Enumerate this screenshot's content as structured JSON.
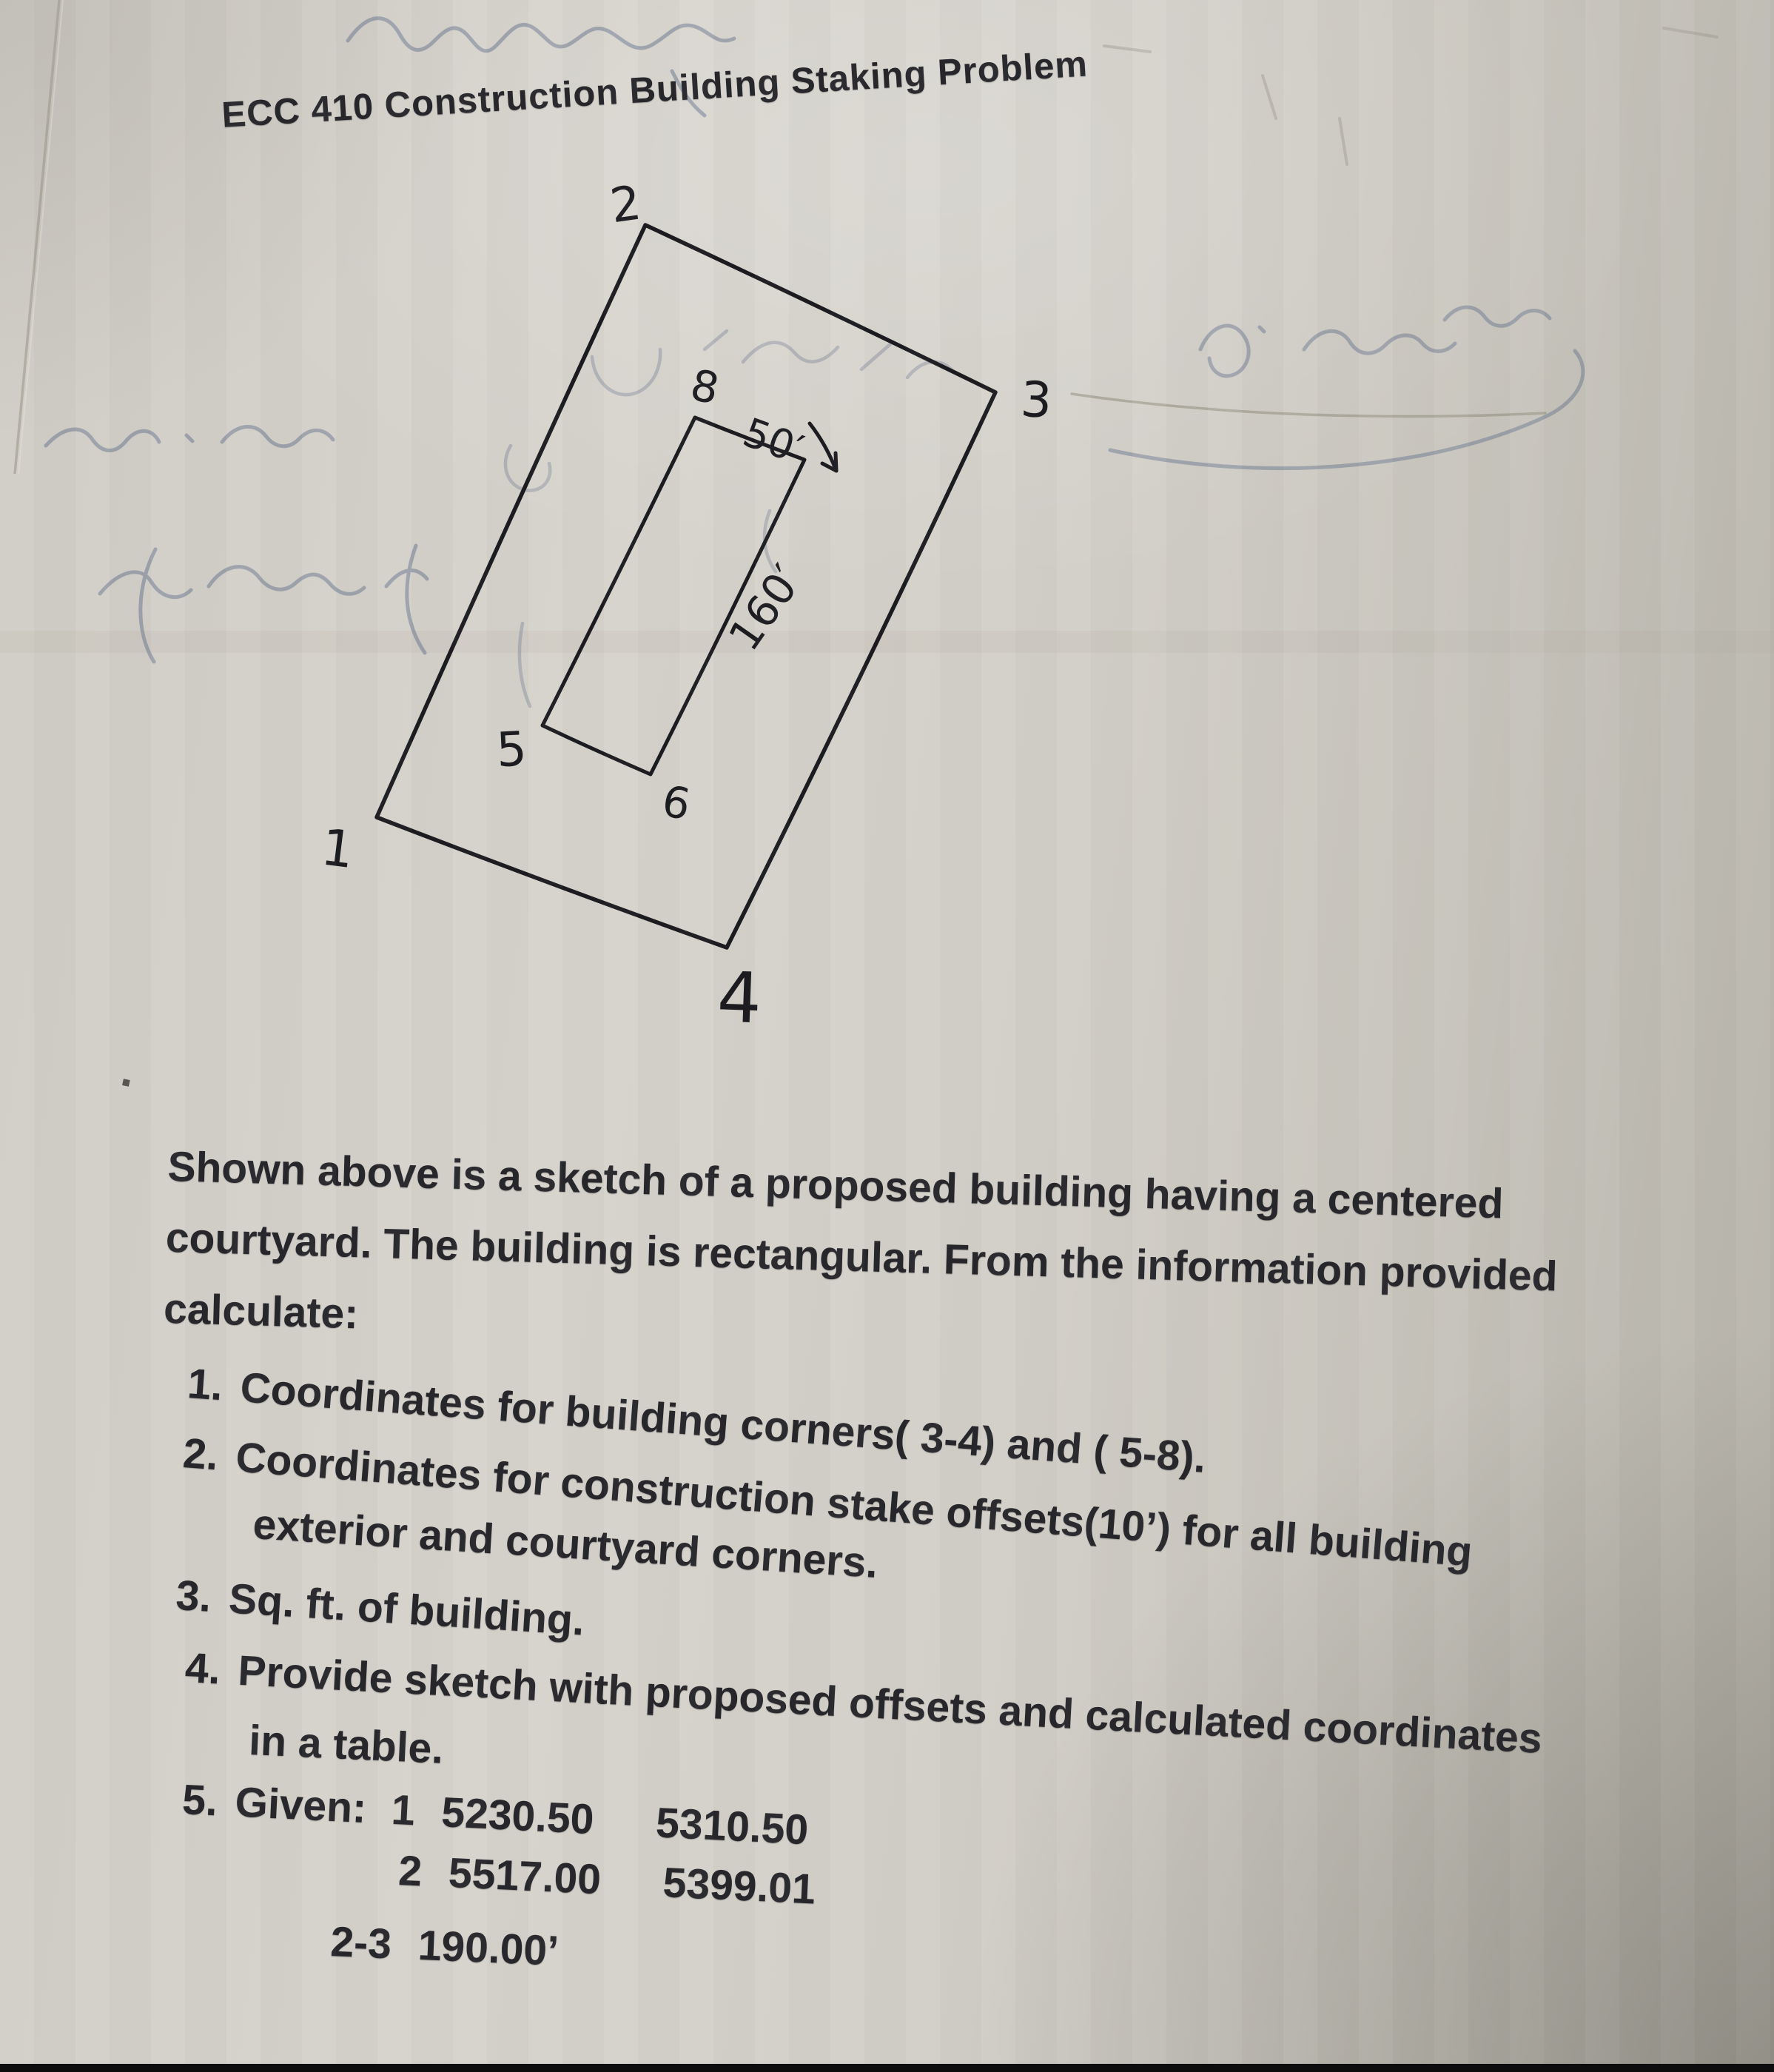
{
  "colors": {
    "paper": "#d2cfc8",
    "printed_ink": "#26262b",
    "sketch_ink": "#1c1c20",
    "bleed_through_ink": "#5e6b88"
  },
  "document": {
    "title": "ECC 410 Construction Building Staking Problem",
    "intro_lines": [
      "Shown above is a sketch of a proposed building having a centered",
      "courtyard. The building is rectangular. From the information provided",
      "calculate:"
    ],
    "tasks": [
      {
        "number": "1.",
        "lines": [
          "Coordinates for building corners( 3-4) and ( 5-8)."
        ]
      },
      {
        "number": "2.",
        "lines": [
          "Coordinates for construction stake offsets(10’) for all building",
          "exterior and courtyard corners."
        ]
      },
      {
        "number": "3.",
        "lines": [
          "Sq. ft. of building."
        ]
      },
      {
        "number": "4.",
        "lines": [
          "Provide sketch with proposed offsets and calculated coordinates",
          "in a table."
        ]
      },
      {
        "number": "5.",
        "lines": [
          "Given:"
        ]
      }
    ],
    "given_rows": [
      {
        "label": "1",
        "col1": "5230.50",
        "col2": "5310.50"
      },
      {
        "label": "2",
        "col1": "5517.00",
        "col2": "5399.01"
      },
      {
        "label": "2-3",
        "col1": "190.00’",
        "col2": ""
      }
    ]
  },
  "sketch": {
    "corner_labels": {
      "c1": "1",
      "c2": "2",
      "c3": "3",
      "c4": "4",
      "c5": "5",
      "c6": "6",
      "c8": "8"
    },
    "dimensions": {
      "courtyard_width": "50′",
      "courtyard_length": "160′"
    }
  }
}
